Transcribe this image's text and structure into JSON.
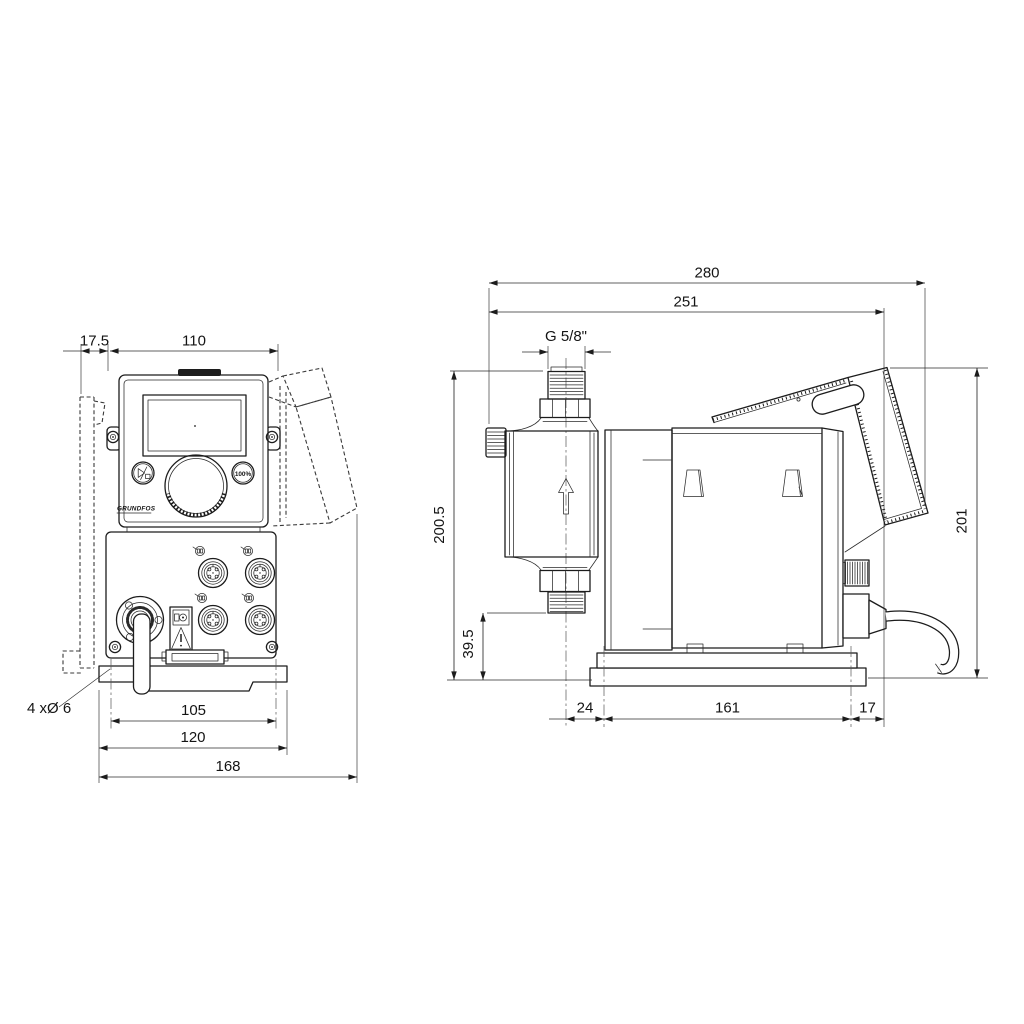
{
  "front_view": {
    "brand": "GRUNDFOS",
    "capacity_button": "100%"
  },
  "front_dimensions": {
    "wall_clearance": "17.5",
    "body_width": "110",
    "mounting_holes": "4 xØ 6",
    "hole_spacing": "105",
    "plate_width": "120",
    "overall_width": "168"
  },
  "side_dimensions": {
    "overall_depth": "280",
    "depth_to_cable_gland": "251",
    "connection_thread": "G 5/8\"",
    "overall_height": "200.5",
    "connection_height": "39.5",
    "control_panel_height": "201",
    "head_to_plate": "24",
    "plate_length": "161",
    "plate_to_gland": "17"
  }
}
